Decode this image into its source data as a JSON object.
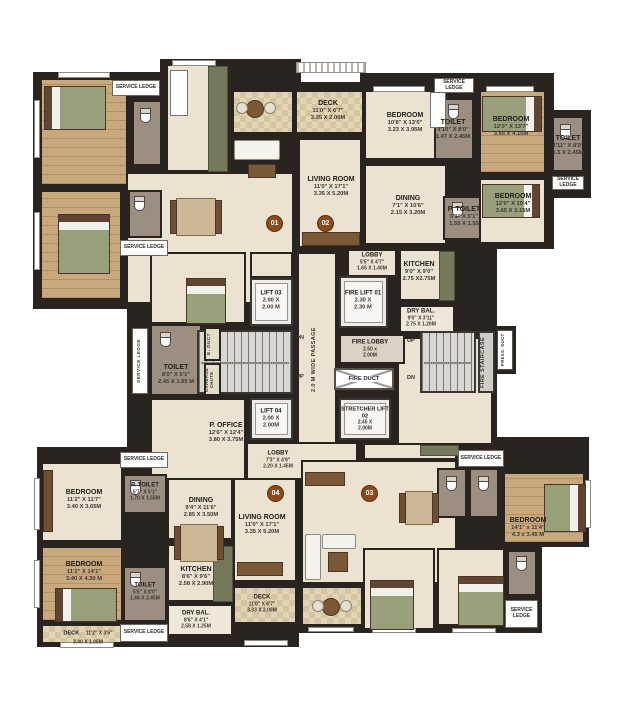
{
  "palette": {
    "wall": "#29241f",
    "floor": "#ece2d1",
    "wood": "#c9a87d",
    "tile": "#e2d5b4",
    "toilet": "#9c8f82",
    "counter": "#75785a",
    "marker": "#8a4a1c"
  },
  "markers": {
    "m01": "01",
    "m02": "02",
    "m03": "03",
    "m04": "04"
  },
  "rooms": {
    "deck01": {
      "name": "DECK",
      "ft": "11'0\" X 6'7\"",
      "m": "3.35 X 2.00M"
    },
    "living02": {
      "name": "LIVING ROOM",
      "ft": "11'0\" X 17'1\"",
      "m": "3.35 X 5.20M"
    },
    "bed02a": {
      "name": "BEDROOM",
      "ft": "10'8\" X 13'0\"",
      "m": "3.23 X 3.95M"
    },
    "toilet02a": {
      "name": "TOILET",
      "ft": "4'10\" X 8'0\"",
      "m": "1.47 X 2.45M"
    },
    "bed02b": {
      "name": "BEDROOM",
      "ft": "12'0\" X 13'7\"",
      "m": "3.65 X 4.15M"
    },
    "toilet02b": {
      "name": "TOILET",
      "ft": "4'11\" X 8'0\"",
      "m": "1.5 X 2.45M"
    },
    "dining02": {
      "name": "DINING",
      "ft": "7'1\" X 10'6\"",
      "m": "2.15 X 3.20M"
    },
    "ptoilet02": {
      "name": "P. TOILET",
      "ft": "5'1\" X 5'1\"",
      "m": "1.55 X 1.55"
    },
    "bed02c": {
      "name": "BEDROOM",
      "ft": "12'0\" X 10'4\"",
      "m": "3.65 X 3.15M"
    },
    "lobby02": {
      "name": "LOBBY",
      "ft": "5'5\" X 4'7\"",
      "m": "1.65 X 1.40M"
    },
    "kitchen02": {
      "name": "KITCHEN",
      "ft": "9'0\" X 9'0\"",
      "m": "2.75 X2.75M"
    },
    "drybal02": {
      "name": "DRY BAL.",
      "ft": "9'0\" X 3'11\"",
      "m": "2.75 X 1.20M"
    },
    "lift03": {
      "name": "LIFT 03",
      "ft": "2.00 X",
      "m": "2.00 M"
    },
    "firelift01": {
      "name": "FIRE LIFT 01",
      "ft": "2.30 X",
      "m": "2.30 M"
    },
    "firelobby": {
      "name": "FIRE LOBBY",
      "ft": "2.50 x",
      "m": "2.00M"
    },
    "lift04": {
      "name": "LIFT 04",
      "ft": "2.00 X",
      "m": "2.00M"
    },
    "stretcher02": {
      "name": "STRETCHER LIFT 02",
      "ft": "2.45 X",
      "m": "2.00M"
    },
    "toiletmid": {
      "name": "TOILET",
      "ft": "8'0\" X 5'1\"",
      "m": "2.45 X 1.55 M"
    },
    "poffice": {
      "name": "P. OFFICE",
      "ft": "12'6\" X 12'4\"",
      "m": "3.80 X 3.75M"
    },
    "lobby04": {
      "name": "LOBBY",
      "ft": "7'3\" X 4'9\"",
      "m": "2.20 X 1.45M"
    },
    "bed04a": {
      "name": "BEDROOM",
      "ft": "11'2\" X 11'7\"",
      "m": "3.40 X 3.65M"
    },
    "ptoilet04": {
      "name": "P. TOILET",
      "ft": "5'7\" X 5'1\"",
      "m": "1.70 X 1.55M"
    },
    "dining04": {
      "name": "DINING",
      "ft": "9'4\" X 11'6\"",
      "m": "2.85 X 3.50M"
    },
    "living04": {
      "name": "LIVING ROOM",
      "ft": "11'0\" X 17'1\"",
      "m": "3.35 X 5.20M"
    },
    "bed04b": {
      "name": "BEDROOM",
      "ft": "11'2\" X 14'1\"",
      "m": "3.40 X 4.30 M"
    },
    "toilet04": {
      "name": "TOILET",
      "ft": "5'5\" X 8'0\"",
      "m": "1.66 X 2.45M"
    },
    "kitchen04": {
      "name": "KITCHEN",
      "ft": "8'6\" X 9'6\"",
      "m": "2.58 X 2.90M"
    },
    "drybal04": {
      "name": "DRY BAL.",
      "ft": "8'6\" X 4'1\"",
      "m": "2.58 X 1.25M"
    },
    "deck04": {
      "name": "DECK",
      "ft": "11'2\" X 3'5\"",
      "m": "3.40 X 1.05M"
    },
    "deck03": {
      "name": "DECK",
      "ft": "11'0\" X 6'7\"",
      "m": "3.33 X 2.00M"
    },
    "bed03a": {
      "name": "BEDROOM",
      "ft": "14'1\" x 11'4\"",
      "m": "4.3 x 3.45 M"
    }
  },
  "misc": {
    "serviceLedge": "SERVICE LEDGE",
    "passage": "2.0 M WIDE PASSAGE",
    "fireStaircase": "FIRE STAIRCASE",
    "pressDuct": "PRESS. DUCT",
    "eDuct": "E. DUCT",
    "garbageChute": "GARBAGE CHUTE",
    "fireDuct": "FIRE DUCT",
    "dn": "DN",
    "up": "UP"
  }
}
